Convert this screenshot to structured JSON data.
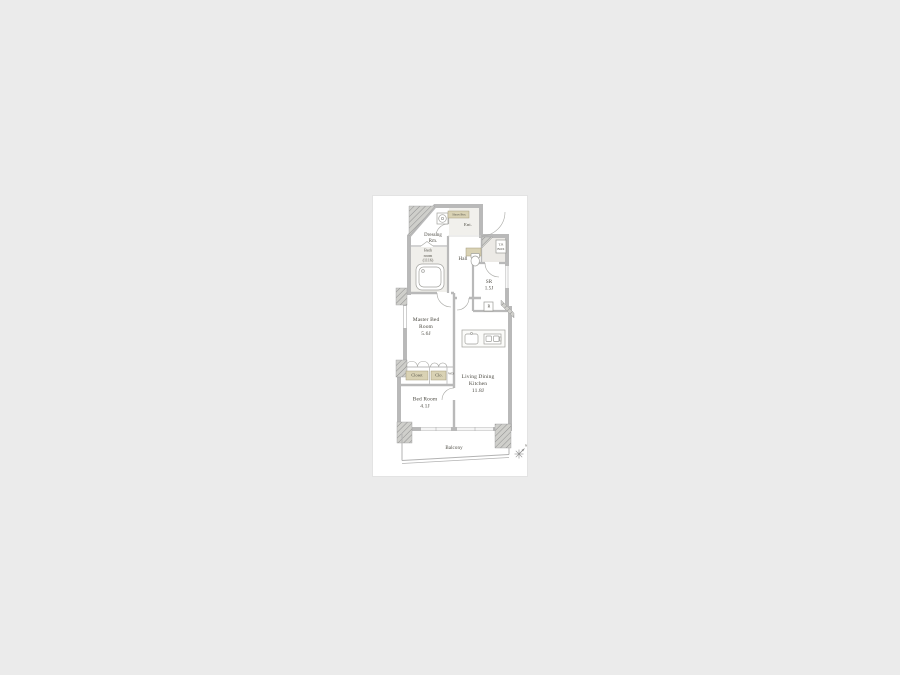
{
  "page": {
    "background": "#ebebeb",
    "card_background": "#ffffff"
  },
  "floorplan": {
    "labels": {
      "master_bedroom": "Master Bed\nRoom\n5.6J",
      "bedroom": "Bed Room\n4.1J",
      "ldk": "Living Dining\nKitchen\n11.8J",
      "service_room": "SR\n1.5J",
      "hall": "Hall",
      "bathroom": "Bath\nroom\n(1116)",
      "dressing_room": "Dressing\nRm.",
      "entrance": "Ent.",
      "balcony": "Balcony",
      "closet": "Closet",
      "clo": "Clo.",
      "washer_dryer": "WD",
      "refrigerator": "R",
      "shoes_box": "Shoes Box",
      "trunk_box": "T.R\nBOX",
      "compass_north": "N"
    },
    "colors": {
      "wall_gray": "#b9b9b9",
      "hatch_gray": "#cfcfcb",
      "tan_accent": "#d9d2b4",
      "label_text": "#4c4a42"
    }
  }
}
